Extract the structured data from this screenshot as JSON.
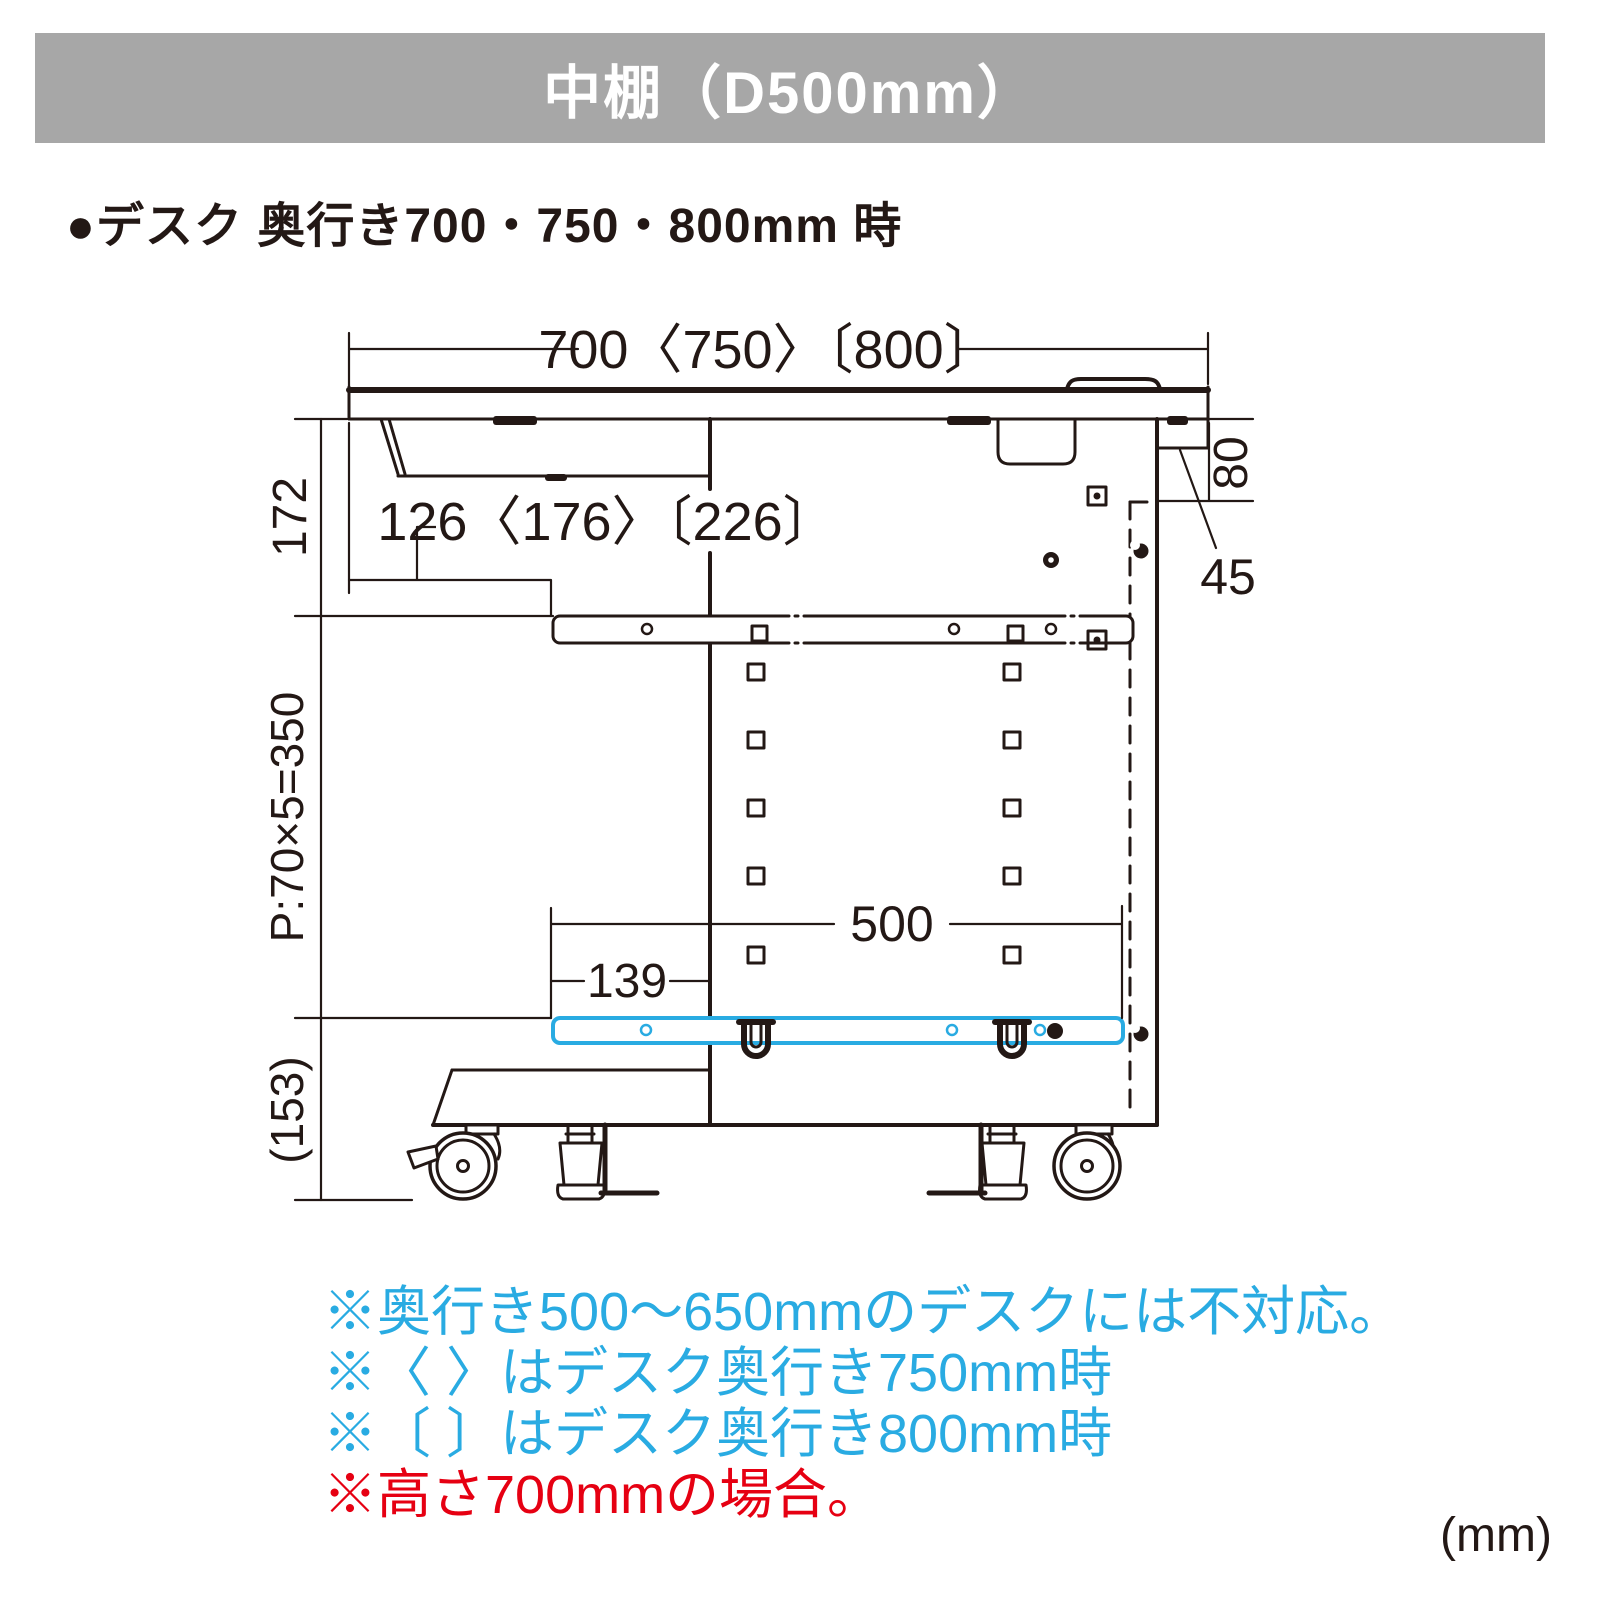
{
  "header": {
    "title": "中棚（D500mm）",
    "bg_color": "#a7a7a7"
  },
  "subheading": "●デスク 奥行き700・750・800mm 時",
  "diagram": {
    "line_color": "#231815",
    "highlight_color": "#29abe2",
    "labels": {
      "desk_depth": "700〈750〉〔800〕",
      "top_clearance": "172",
      "shelf_front_setback": "126〈176〉〔226〕",
      "rear_rail_height": "80",
      "rear_overhang": "45",
      "pitch": "P:70×5=350",
      "shelf_depth": "500",
      "front_offset": "139",
      "floor_clearance": "(153)"
    }
  },
  "notes": {
    "lines": [
      {
        "text": "※奥行き500〜650mmのデスクには不対応。",
        "color": "#29abe2"
      },
      {
        "text": "※〈 〉はデスク奥行き750mm時",
        "color": "#29abe2"
      },
      {
        "text": "※〔 〕はデスク奥行き800mm時",
        "color": "#29abe2"
      },
      {
        "text": "※高さ700mmの場合。",
        "color": "#e60012"
      }
    ],
    "unit_label": "(mm)"
  }
}
